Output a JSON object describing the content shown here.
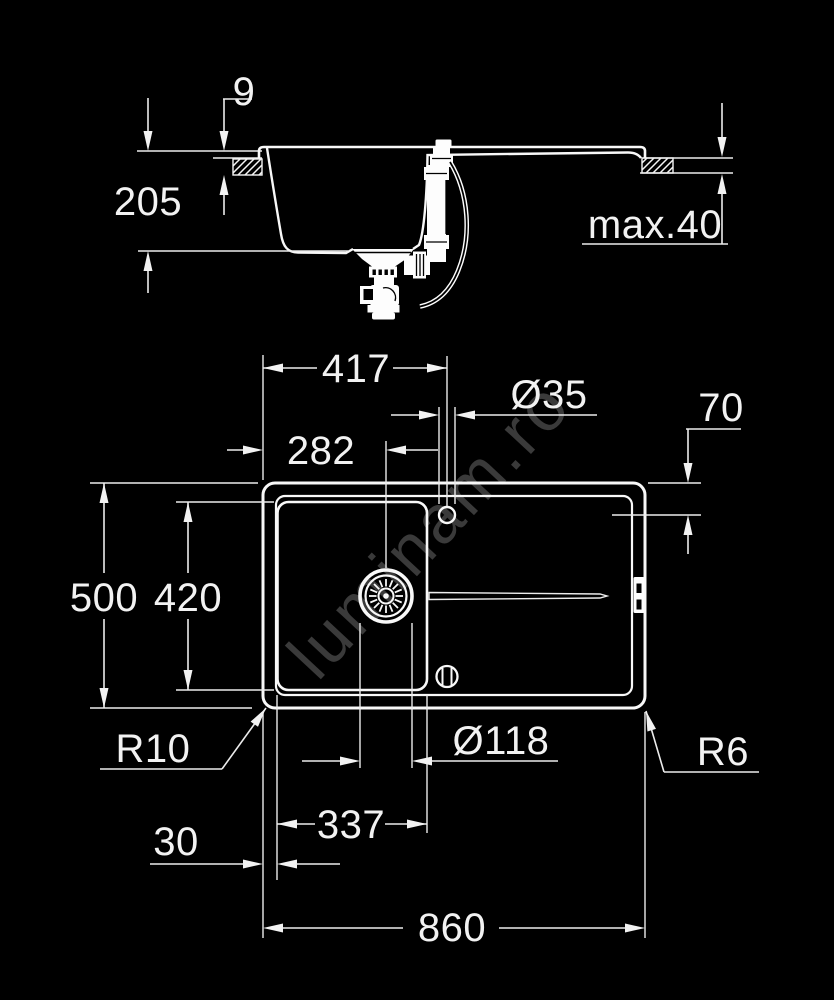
{
  "watermark": "luminam.ro",
  "colors": {
    "background": "#000000",
    "line": "#f5f5f5",
    "text": "#f2f2f2",
    "watermark_gray": "#3a3a3a"
  },
  "section_view": {
    "labels": {
      "rim_height": "9",
      "depth": "205",
      "countertop_max_thickness": "max.40"
    }
  },
  "plan_view": {
    "labels": {
      "faucet_from_left": "417",
      "faucet_hole_diameter": "Ø35",
      "faucet_from_top": "70",
      "drain_from_left": "282",
      "overall_depth": "500",
      "bowl_inner_depth": "420",
      "outer_corner_radius": "R10",
      "drain_diameter": "Ø118",
      "inner_corner_radius": "R6",
      "rim_width_left": "30",
      "bowl_inner_width": "337",
      "overall_width": "860"
    }
  }
}
